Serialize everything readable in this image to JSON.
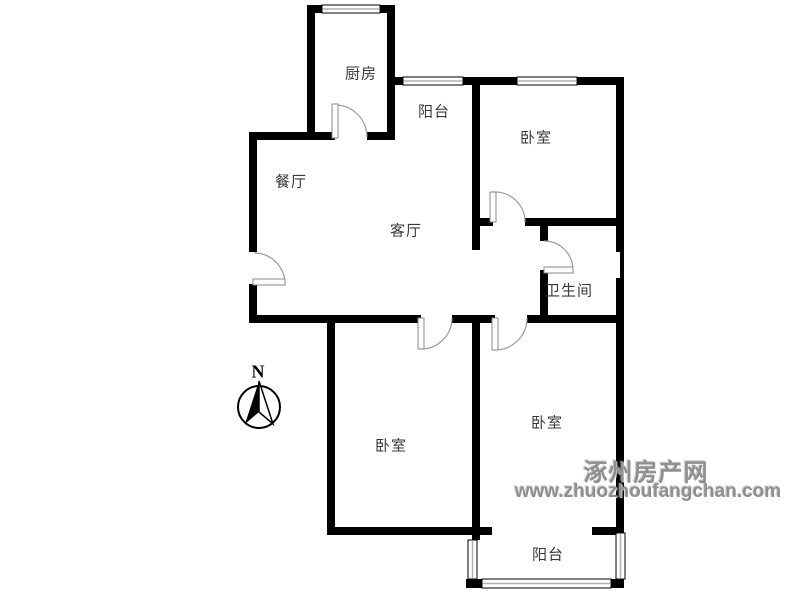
{
  "rooms": [
    {
      "id": "kitchen",
      "label": "厨房"
    },
    {
      "id": "balcony-top",
      "label": "阳台"
    },
    {
      "id": "bedroom-top-right",
      "label": "卧室"
    },
    {
      "id": "dining-room",
      "label": "餐厅"
    },
    {
      "id": "living-room",
      "label": "客厅"
    },
    {
      "id": "bathroom",
      "label": "卫生间"
    },
    {
      "id": "bedroom-bottom-left",
      "label": "卧室"
    },
    {
      "id": "bedroom-bottom-right",
      "label": "卧室"
    },
    {
      "id": "balcony-bottom",
      "label": "阳台"
    }
  ],
  "compass": {
    "north_label": "N"
  },
  "watermark": {
    "site_name": "涿州房产网",
    "site_url": "www.zhuozhoufangchan.com"
  },
  "colors": {
    "wall": "#000000",
    "door_arc": "#9a9a9a",
    "door_leaf_fill": "#fcfcfc",
    "window_center_line": "#b0b0b0",
    "room_label": "#3a3a3a",
    "watermark": "#8f8f8f",
    "background": "#ffffff"
  }
}
